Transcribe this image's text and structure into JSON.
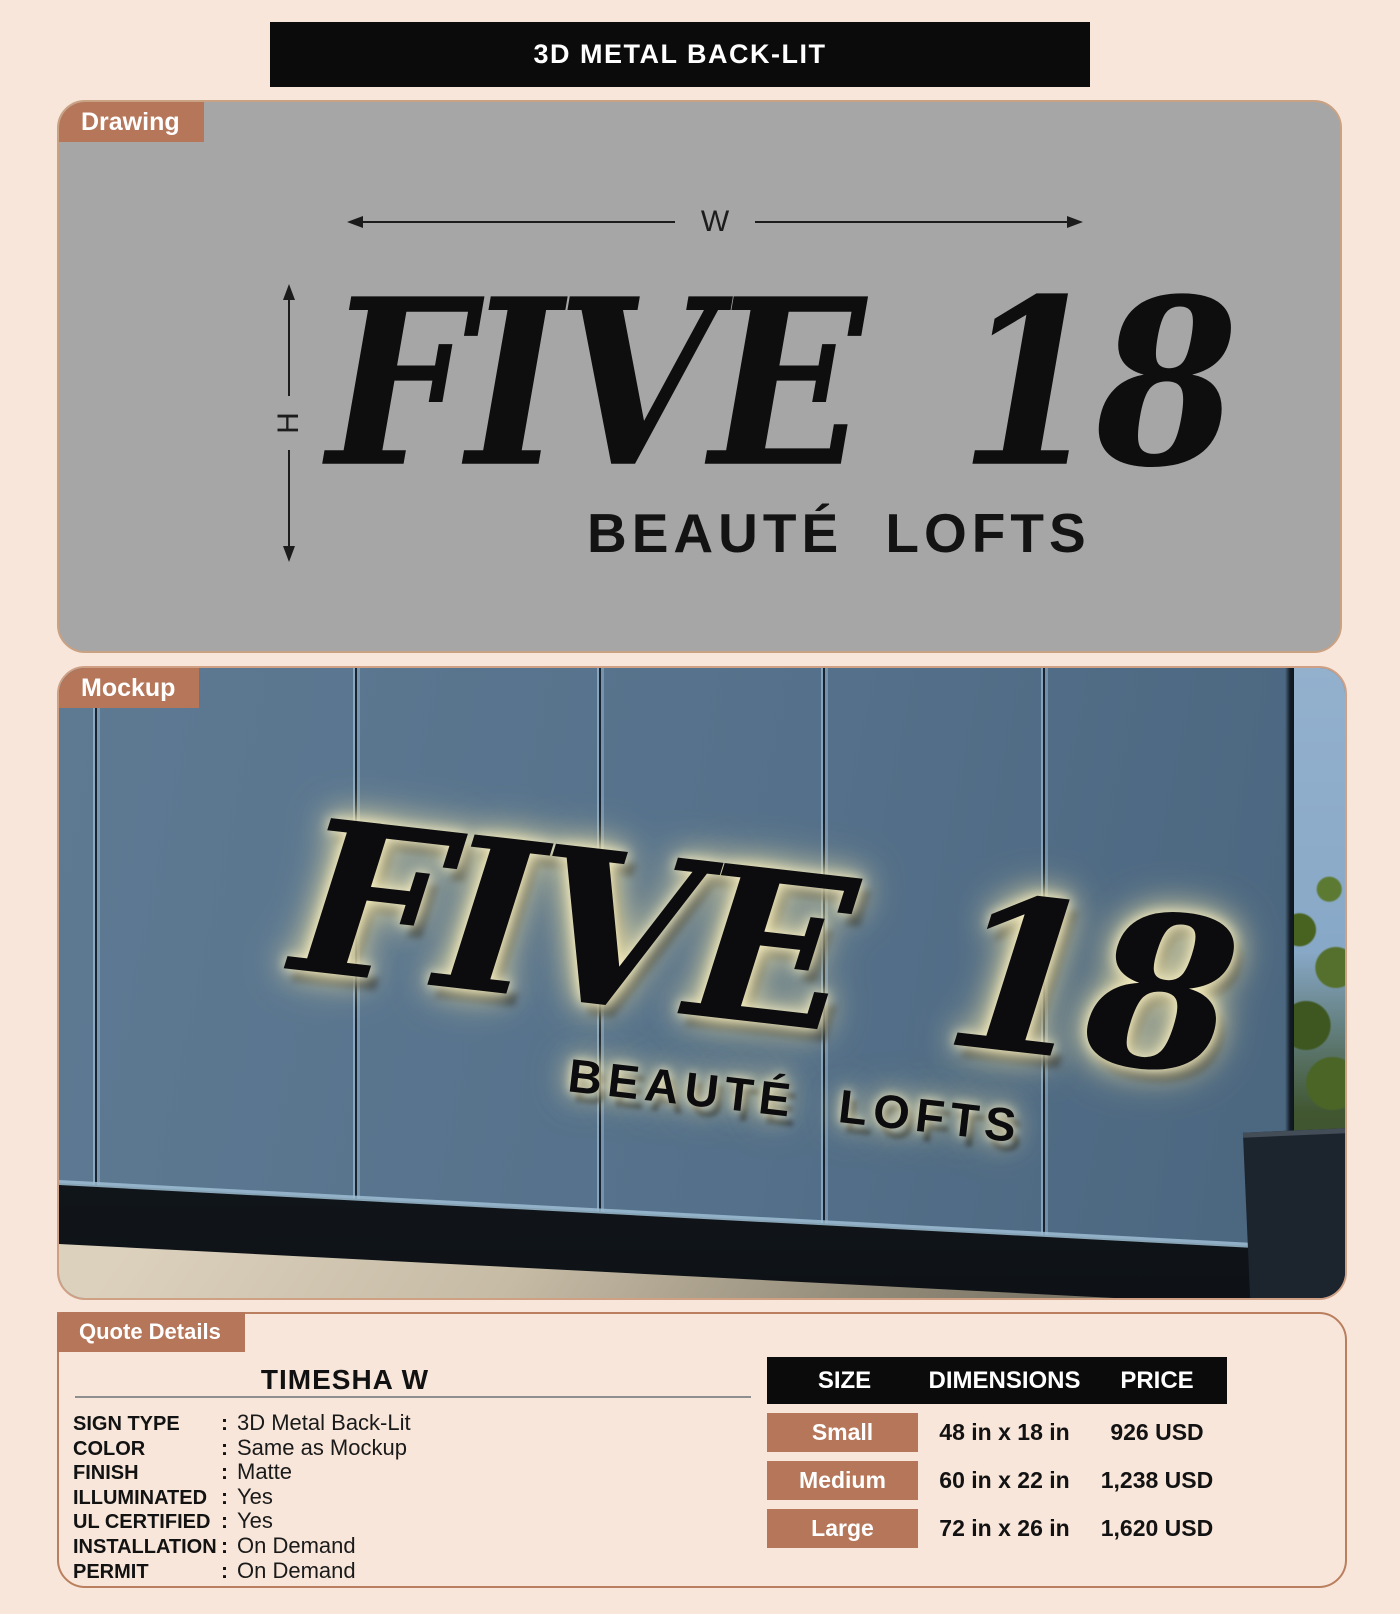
{
  "header": {
    "title": "3D METAL BACK-LIT"
  },
  "drawing": {
    "tab": "Drawing",
    "width_label": "W",
    "height_label": "H",
    "logo_line1": "FIVE 18",
    "logo_line2": "BEAUTÉ LOFTS"
  },
  "mockup": {
    "tab": "Mockup",
    "sign_line1": "FIVE 18",
    "sign_line2": "BEAUTÉ LOFTS"
  },
  "quote": {
    "tab": "Quote Details",
    "customer_name": "TIMESHA W",
    "colon": ":",
    "details": [
      {
        "label": "SIGN TYPE",
        "value": "3D Metal Back-Lit"
      },
      {
        "label": "COLOR",
        "value": "Same as Mockup"
      },
      {
        "label": "FINISH",
        "value": "Matte"
      },
      {
        "label": "ILLUMINATED",
        "value": "Yes"
      },
      {
        "label": "UL CERTIFIED",
        "value": "Yes"
      },
      {
        "label": "INSTALLATION",
        "value": "On Demand"
      },
      {
        "label": "PERMIT",
        "value": "On Demand"
      }
    ],
    "pricing_table": {
      "headers": [
        "SIZE",
        "DIMENSIONS",
        "PRICE"
      ],
      "rows": [
        {
          "size": "Small",
          "dimensions": "48 in x 18 in",
          "price": "926 USD"
        },
        {
          "size": "Medium",
          "dimensions": "60 in x 22 in",
          "price": "1,238 USD"
        },
        {
          "size": "Large",
          "dimensions": "72 in x 26 in",
          "price": "1,620 USD"
        }
      ]
    }
  },
  "colors": {
    "page_background": "#f8e6da",
    "accent_brown": "#b5765a",
    "header_black": "#0b0b0b",
    "drawing_gray": "#a6a6a6",
    "wall_blue": "#54708a",
    "backlit_glow": "#f0e5ae"
  }
}
